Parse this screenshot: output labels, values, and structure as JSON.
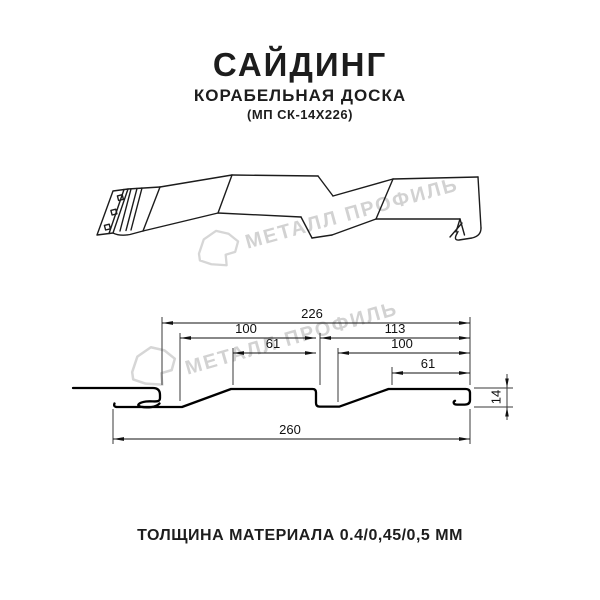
{
  "header": {
    "title": "САЙДИНГ",
    "subtitle": "КОРАБЕЛЬНАЯ ДОСКА",
    "model_code": "(МП СК-14Х226)"
  },
  "footer": {
    "thickness_note": "ТОЛЩИНА МАТЕРИАЛА 0.4/0,45/0,5 ММ"
  },
  "watermark": {
    "text": "МЕТАЛЛ ПРОФИЛЬ",
    "color": "#d2d2d2"
  },
  "dimensions": {
    "overall_top": "226",
    "left_board_width": "100",
    "left_crest_width": "61",
    "right_board_width": "113",
    "right_inner_width": "100",
    "right_crest_width": "61",
    "overall_bottom": "260",
    "profile_height": "14"
  },
  "colors": {
    "line": "#1a1a1a",
    "text": "#1d1d1d",
    "watermark": "#d2d2d2",
    "background": "#ffffff"
  }
}
